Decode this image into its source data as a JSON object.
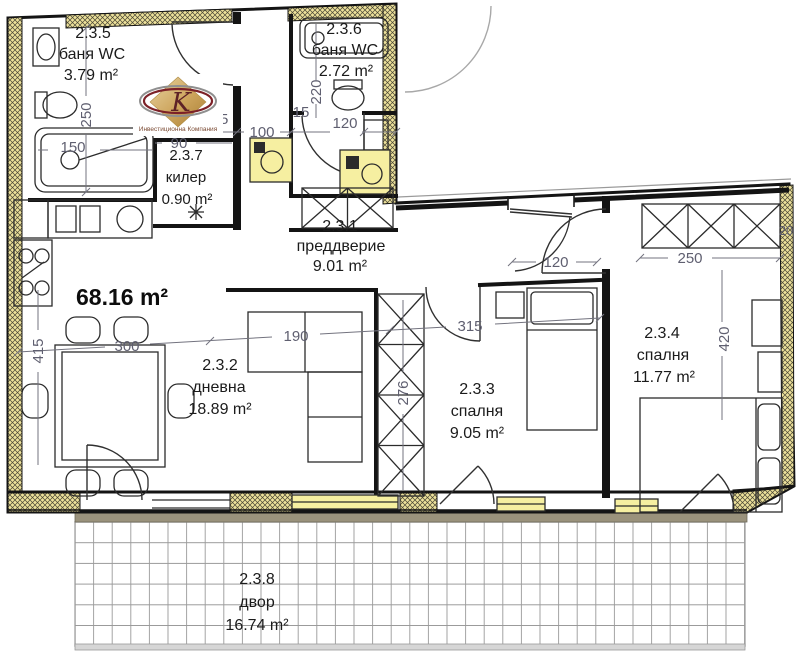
{
  "plan": {
    "total_area_label": "68.16 m²",
    "rooms": [
      {
        "id": "2.3.1",
        "name": "преддверие",
        "area": "9.01 m²"
      },
      {
        "id": "2.3.2",
        "name": "дневна",
        "area": "18.89 m²"
      },
      {
        "id": "2.3.3",
        "name": "спалня",
        "area": "9.05 m²"
      },
      {
        "id": "2.3.4",
        "name": "спалня",
        "area": "11.77 m²"
      },
      {
        "id": "2.3.5",
        "name": "баня WC",
        "area": "3.79 m²"
      },
      {
        "id": "2.3.6",
        "name": "баня WC",
        "area": "2.72 m²"
      },
      {
        "id": "2.3.7",
        "name": "килер",
        "area": "0.90 m²"
      },
      {
        "id": "2.3.8",
        "name": "двор",
        "area": "16.74 m²"
      }
    ],
    "dimensions": {
      "bath1_height": "250",
      "bathtub": "150",
      "corridor_width": "90",
      "wall_a": "15",
      "niche": "100",
      "wall_b": "15",
      "bath2_width": "120",
      "bath2_height": "220",
      "living_width": "300",
      "sofa_width": "190",
      "hall_width": "315",
      "living_height": "415",
      "wardrobe_height": "276",
      "entry_door": "120",
      "bedroom2_width": "250",
      "bedroom2_height": "420",
      "edge": "20"
    },
    "colors": {
      "floor_fill": "#f6efa1",
      "wall": "#141414",
      "dimension_text": "#5f5f70",
      "sill": "#9a927c"
    }
  },
  "logo": {
    "monogram": "K",
    "caption": "Инвестиционна Компания"
  }
}
